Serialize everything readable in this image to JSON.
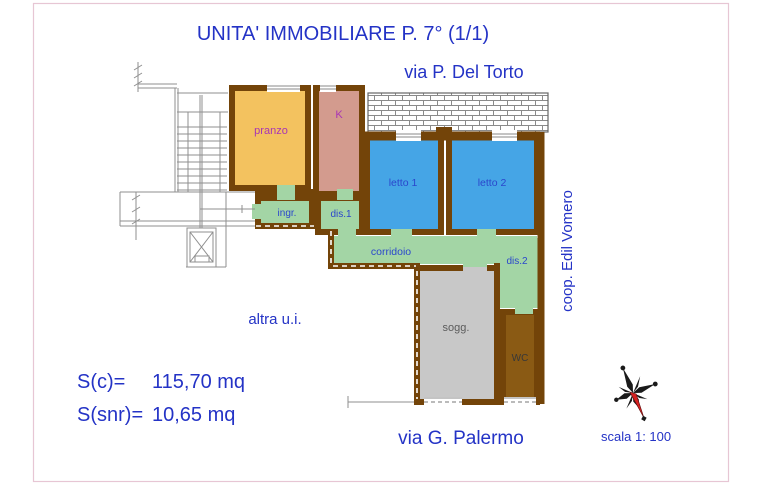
{
  "title": "UNITA' IMMOBILIARE P. 7° (1/1)",
  "streets": {
    "top": "via P. Del Torto",
    "bottom": "via G. Palermo"
  },
  "cooperative": "coop. Edil Vomero",
  "rooms": {
    "pranzo": "pranzo",
    "k": "K",
    "letto1": "letto 1",
    "letto2": "letto 2",
    "ingr": "ingr.",
    "dis1": "dis.1",
    "corridoio": "corridoio",
    "dis2": "dis.2",
    "sogg": "sogg.",
    "wc": "WC"
  },
  "annotations": {
    "other_unit": "altra u.i.",
    "scale": "scala 1: 100"
  },
  "measurements": {
    "s_c": {
      "label": "S(c)=",
      "value": "115,70 mq"
    },
    "s_snr": {
      "label": "S(snr)=",
      "value": "10,65 mq"
    }
  },
  "colors": {
    "wall": "#734409",
    "pranzo": "#f3c25f",
    "kitchen": "#d39b8e",
    "bedroom": "#45a5e6",
    "circulation": "#a3d5a5",
    "living": "#c8c8c8",
    "wc": "#8a5a14",
    "frame_pink": "#e7c6d4",
    "compass_red": "#d42222",
    "label_blue": "#2a46cc",
    "label_purple": "#a835b5",
    "title_blue": "#2433c6"
  }
}
